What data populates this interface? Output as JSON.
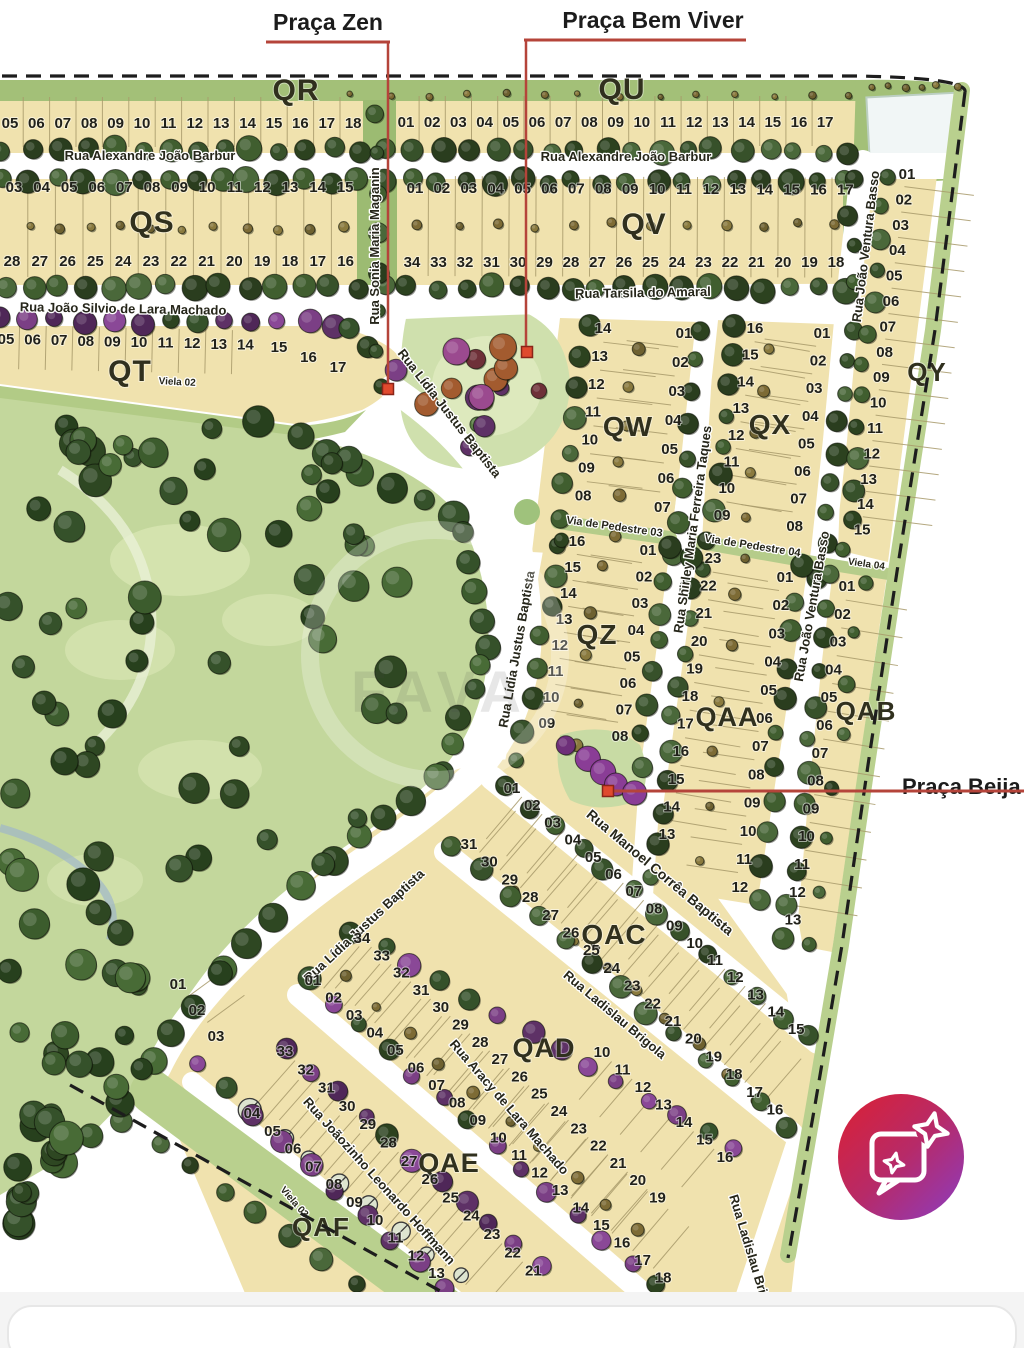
{
  "annotations": {
    "accent_color": "#b5443a",
    "praca_zen": {
      "text": "Praça Zen",
      "tx": 328,
      "ty": 30,
      "underline": [
        266,
        42,
        390,
        42
      ],
      "vline": [
        388,
        42,
        388,
        385
      ],
      "marker": [
        388,
        389
      ]
    },
    "praca_bem_viver": {
      "text": "Praça Bem Viver",
      "tx": 653,
      "ty": 28,
      "underline": [
        524,
        40,
        746,
        40
      ],
      "vline": [
        526,
        40,
        526,
        348
      ],
      "marker": [
        527,
        352
      ]
    },
    "praca_beija": {
      "text": "Praça Beija",
      "tx": 902,
      "ty": 794,
      "hline": [
        610,
        791,
        1024,
        791
      ],
      "marker": [
        608,
        791
      ]
    }
  },
  "watermark": {
    "text": "FAVA"
  },
  "blocks": [
    {
      "id": "QR",
      "label": "QR",
      "x": 296,
      "y": 100,
      "size": 30
    },
    {
      "id": "QU",
      "label": "QU",
      "x": 622,
      "y": 99,
      "size": 30
    },
    {
      "id": "QS",
      "label": "QS",
      "x": 152,
      "y": 232,
      "size": 30
    },
    {
      "id": "QV",
      "label": "QV",
      "x": 644,
      "y": 234,
      "size": 30
    },
    {
      "id": "QT",
      "label": "QT",
      "x": 130,
      "y": 381,
      "size": 30
    },
    {
      "id": "QY",
      "label": "QY",
      "x": 927,
      "y": 381,
      "size": 26
    },
    {
      "id": "QW",
      "label": "QW",
      "x": 628,
      "y": 436,
      "size": 28
    },
    {
      "id": "QX",
      "label": "QX",
      "x": 770,
      "y": 434,
      "size": 28
    },
    {
      "id": "QZ",
      "label": "QZ",
      "x": 597,
      "y": 644,
      "size": 28
    },
    {
      "id": "QAA",
      "label": "QAA",
      "x": 727,
      "y": 726,
      "size": 27
    },
    {
      "id": "QAB",
      "label": "QAB",
      "x": 866,
      "y": 720,
      "size": 26
    },
    {
      "id": "QAC",
      "label": "QAC",
      "x": 614,
      "y": 944,
      "size": 28
    },
    {
      "id": "QAD",
      "label": "QAD",
      "x": 544,
      "y": 1057,
      "size": 27
    },
    {
      "id": "QAE",
      "label": "QAE",
      "x": 449,
      "y": 1172,
      "size": 27
    },
    {
      "id": "QAF",
      "label": "QAF",
      "x": 321,
      "y": 1236,
      "size": 26
    }
  ],
  "street_labels": [
    {
      "text": "Rua Alexandre João Barbur",
      "x": 150,
      "y": 160,
      "rot": 0,
      "size": 13
    },
    {
      "text": "Rua Alexandre João Barbur",
      "x": 626,
      "y": 161,
      "rot": 0,
      "size": 13
    },
    {
      "text": "Rua Sonia Maria Maganin",
      "x": 379,
      "y": 246,
      "rot": -90,
      "size": 13
    },
    {
      "text": "Rua João Ventura Basso",
      "x": 870,
      "y": 247,
      "rot": -83,
      "size": 13
    },
    {
      "text": "Rua João Ventura Basso",
      "x": 816,
      "y": 607,
      "rot": -80,
      "size": 13
    },
    {
      "text": "Rua João Silvio de Lara Machado",
      "x": 123,
      "y": 313,
      "rot": 1,
      "size": 13
    },
    {
      "text": "Rua Tarsila do Amaral",
      "x": 643,
      "y": 297,
      "rot": -1,
      "size": 13
    },
    {
      "text": "Rua Lídia Justus Baptista",
      "x": 446,
      "y": 416,
      "rot": 52,
      "size": 13
    },
    {
      "text": "Rua Lídia  Justus Baptista",
      "x": 521,
      "y": 650,
      "rot": -80,
      "size": 13
    },
    {
      "text": "Rua Lídia Justus Baptista",
      "x": 367,
      "y": 929,
      "rot": -43,
      "size": 13
    },
    {
      "text": "Rua Shirley Maria Ferreira Taques",
      "x": 697,
      "y": 530,
      "rot": -82,
      "size": 13
    },
    {
      "text": "Via de Pedestre 03",
      "x": 614,
      "y": 530,
      "rot": 8,
      "size": 11
    },
    {
      "text": "Via de Pedestre 04",
      "x": 752,
      "y": 549,
      "rot": 9,
      "size": 11
    },
    {
      "text": "Viela 04",
      "x": 866,
      "y": 567,
      "rot": 8,
      "size": 10
    },
    {
      "text": "Viela 02",
      "x": 177,
      "y": 385,
      "rot": 3,
      "size": 10
    },
    {
      "text": "Viela 03",
      "x": 292,
      "y": 1204,
      "rot": 49,
      "size": 10
    },
    {
      "text": "Rua Manoel Corrêa Baptista",
      "x": 657,
      "y": 876,
      "rot": 40,
      "size": 14
    },
    {
      "text": "Rua Ladislau Brigola",
      "x": 612,
      "y": 1018,
      "rot": 40,
      "size": 13
    },
    {
      "text": "Rua Ladislau Brigola",
      "x": 748,
      "y": 1258,
      "rot": 73,
      "size": 13
    },
    {
      "text": "Rua Aracy de Lara Machado",
      "x": 506,
      "y": 1110,
      "rot": 49,
      "size": 13
    },
    {
      "text": "Rua Joãozinho Leonardo Hoffmann",
      "x": 376,
      "y": 1184,
      "rot": 48,
      "size": 13
    }
  ],
  "lot_rows": [
    {
      "block": "QR",
      "x": 10,
      "y": 128,
      "dx": 26.4,
      "dy": 0,
      "lots": [
        "05",
        "06",
        "07",
        "08",
        "09",
        "10",
        "11",
        "12",
        "13",
        "14",
        "15",
        "16",
        "17",
        "18"
      ],
      "div": {
        "len": 50,
        "off": -1
      }
    },
    {
      "block": "QU",
      "x": 406,
      "y": 127,
      "dx": 26.2,
      "dy": 0,
      "lots": [
        "01",
        "02",
        "03",
        "04",
        "05",
        "06",
        "07",
        "08",
        "09",
        "10",
        "11",
        "12",
        "13",
        "14",
        "15",
        "16",
        "17"
      ],
      "div": {
        "len": 50,
        "off": -1
      }
    },
    {
      "block": "QS",
      "x": 14,
      "y": 192,
      "dx": 27.6,
      "dy": 0,
      "lots": [
        "03",
        "04",
        "05",
        "06",
        "07",
        "08",
        "09",
        "10",
        "11",
        "12",
        "13",
        "14",
        "15"
      ],
      "div": {
        "len": 100,
        "off": 40
      }
    },
    {
      "block": "QS",
      "x": 12,
      "y": 266,
      "dx": 27.8,
      "dy": 0,
      "lots": [
        "28",
        "27",
        "26",
        "25",
        "24",
        "23",
        "22",
        "21",
        "20",
        "19",
        "18",
        "17",
        "16"
      ]
    },
    {
      "block": "QV",
      "x": 415,
      "y": 193,
      "dx": 26.9,
      "dy": 0.1,
      "lots": [
        "01",
        "02",
        "03",
        "04",
        "05",
        "06",
        "07",
        "08",
        "09",
        "10",
        "11",
        "12",
        "13",
        "14",
        "15",
        "16",
        "17"
      ],
      "div": {
        "len": 100,
        "off": 38
      }
    },
    {
      "block": "QV",
      "x": 412,
      "y": 267,
      "dx": 26.5,
      "dy": 0,
      "lots": [
        "34",
        "33",
        "32",
        "31",
        "30",
        "29",
        "28",
        "27",
        "26",
        "25",
        "24",
        "23",
        "22",
        "21",
        "20",
        "19",
        "18"
      ]
    },
    {
      "block": "QT",
      "x": 6,
      "y": 344,
      "dx": 26.6,
      "dy": 0.6,
      "lots": [
        "05",
        "06",
        "07",
        "08",
        "09",
        "10",
        "11",
        "12",
        "13",
        "14"
      ],
      "div": {
        "len": 44,
        "off": 8
      }
    },
    {
      "block": "QT",
      "x": 279,
      "y": 352,
      "dx": 29.5,
      "dy": 10,
      "lots": [
        "15",
        "16",
        "17"
      ]
    },
    {
      "block": "QY",
      "x": 907,
      "y": 179,
      "dx": -3.2,
      "dy": 25.4,
      "lots": [
        "01",
        "02",
        "03",
        "04",
        "05",
        "06",
        "07",
        "08",
        "09",
        "10",
        "11",
        "12",
        "13",
        "14",
        "15"
      ],
      "div": {
        "len": 70,
        "off": -34
      }
    },
    {
      "block": "QW",
      "x": 603,
      "y": 333,
      "dx": -3.3,
      "dy": 27.9,
      "lots": [
        "14",
        "13",
        "12",
        "11",
        "10",
        "09",
        "08"
      ],
      "div": {
        "len": 56,
        "off": -30
      }
    },
    {
      "block": "QW",
      "x": 684,
      "y": 338,
      "dx": -3.6,
      "dy": 29,
      "lots": [
        "01",
        "02",
        "03",
        "04",
        "05",
        "06",
        "07"
      ],
      "div": {
        "len": 52,
        "off": 30
      }
    },
    {
      "block": "QX",
      "x": 755,
      "y": 333,
      "dx": -4.7,
      "dy": 26.7,
      "lots": [
        "16",
        "15",
        "14",
        "13",
        "12",
        "11",
        "10",
        "09"
      ],
      "div": {
        "len": 56,
        "off": -30
      }
    },
    {
      "block": "QX",
      "x": 822,
      "y": 338,
      "dx": -3.9,
      "dy": 27.6,
      "lots": [
        "01",
        "02",
        "03",
        "04",
        "05",
        "06",
        "07",
        "08"
      ],
      "div": {
        "len": 52,
        "off": 30
      }
    },
    {
      "block": "QZ",
      "x": 577,
      "y": 546,
      "dx": -4.3,
      "dy": 26,
      "lots": [
        "16",
        "15",
        "14",
        "13",
        "12",
        "11",
        "10",
        "09"
      ],
      "div": {
        "len": 56,
        "off": -30
      }
    },
    {
      "block": "QZ",
      "x": 648,
      "y": 555,
      "dx": -4,
      "dy": 26.6,
      "lots": [
        "01",
        "02",
        "03",
        "04",
        "05",
        "06",
        "07",
        "08"
      ],
      "div": {
        "len": 52,
        "off": 30
      }
    },
    {
      "block": "QAA",
      "x": 713,
      "y": 563,
      "dx": -4.6,
      "dy": 27.6,
      "lots": [
        "23",
        "22",
        "21",
        "20",
        "19",
        "18",
        "17",
        "16",
        "15",
        "14",
        "13"
      ],
      "div": {
        "len": 56,
        "off": -30
      }
    },
    {
      "block": "QAA",
      "x": 785,
      "y": 582,
      "dx": -4.1,
      "dy": 28.2,
      "lots": [
        "01",
        "02",
        "03",
        "04",
        "05",
        "06",
        "07",
        "08",
        "09",
        "10",
        "11",
        "12"
      ],
      "div": {
        "len": 52,
        "off": 30
      }
    },
    {
      "block": "QAB",
      "x": 847,
      "y": 591,
      "dx": -4.5,
      "dy": 27.8,
      "lots": [
        "01",
        "02",
        "03",
        "04",
        "05",
        "06",
        "07",
        "08",
        "09",
        "10",
        "11",
        "12",
        "13"
      ],
      "div": {
        "len": 62,
        "off": -32
      }
    },
    {
      "block": "QAC",
      "x": 512,
      "y": 793,
      "dx": 20.3,
      "dy": 17.2,
      "lots": [
        "01",
        "02",
        "03",
        "04",
        "05",
        "06",
        "07",
        "08",
        "09",
        "10",
        "11",
        "12",
        "13",
        "14",
        "15"
      ],
      "div": {
        "len": 55,
        "off": 28
      }
    },
    {
      "block": "QAC",
      "x": 469,
      "y": 849,
      "dx": 20.4,
      "dy": 17.7,
      "lots": [
        "31",
        "30",
        "29",
        "28",
        "27",
        "26",
        "25",
        "24",
        "23",
        "22",
        "21",
        "20",
        "19",
        "18",
        "17",
        "16"
      ],
      "div": {
        "len": 55,
        "off": -28
      }
    },
    {
      "block": "QAD",
      "x": 313,
      "y": 985,
      "dx": 20.6,
      "dy": 17.5,
      "lots": [
        "01",
        "02",
        "03",
        "04",
        "05",
        "06",
        "07",
        "08",
        "09",
        "10",
        "11",
        "12",
        "13",
        "14",
        "15",
        "16",
        "17",
        "18"
      ],
      "div": {
        "len": 55,
        "off": -28
      }
    },
    {
      "block": "QAD",
      "x": 362,
      "y": 943,
      "dx": 19.7,
      "dy": 17.3,
      "lots": [
        "34",
        "33",
        "32",
        "31",
        "30",
        "29",
        "28",
        "27",
        "26",
        "25",
        "24",
        "23",
        "22",
        "21",
        "20",
        "19"
      ],
      "div": {
        "len": 55,
        "off": 28
      }
    },
    {
      "block": "QAD",
      "x": 602,
      "y": 1057,
      "dx": 20.5,
      "dy": 17.5,
      "lots": [
        "10",
        "11",
        "12",
        "13",
        "14",
        "15",
        "16"
      ],
      "div": {
        "len": 50,
        "off": 26
      }
    },
    {
      "block": "QAE",
      "x": 178,
      "y": 989,
      "dx": 19,
      "dy": 26,
      "lots": [
        "01",
        "02",
        "03"
      ],
      "div": {
        "len": 46,
        "off": -24
      }
    },
    {
      "block": "QAE",
      "x": 252,
      "y": 1118,
      "dx": 20.5,
      "dy": 17.8,
      "lots": [
        "04",
        "05",
        "06",
        "07",
        "08",
        "09",
        "10",
        "11",
        "12",
        "13"
      ],
      "div": {
        "len": 55,
        "off": -28
      }
    },
    {
      "block": "QAE",
      "x": 285,
      "y": 1056,
      "dx": 20.7,
      "dy": 18.3,
      "lots": [
        "33",
        "32",
        "31",
        "30",
        "29",
        "28",
        "27",
        "26",
        "25",
        "24",
        "23",
        "22",
        "21"
      ],
      "div": {
        "len": 55,
        "off": 28
      }
    }
  ],
  "fab": {
    "icon": "chat-sparkle-icon",
    "gradient": [
      "#d82138",
      "#b72a68",
      "#8e3bbb"
    ]
  }
}
